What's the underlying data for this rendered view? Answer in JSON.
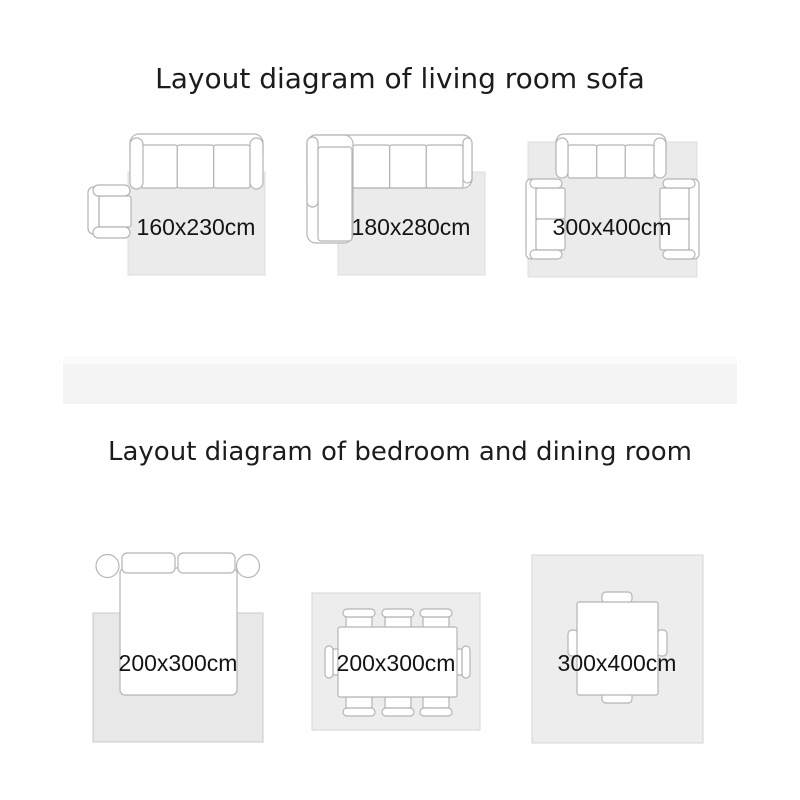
{
  "sections": {
    "living_room": {
      "title": "Layout diagram of living room sofa",
      "diagrams": [
        {
          "label": "160x230cm",
          "furniture": "three-seat sofa with side armchair on rug"
        },
        {
          "label": "180x280cm",
          "furniture": "L-shaped sectional sofa on rug"
        },
        {
          "label": "300x400cm",
          "furniture": "three-seat sofa with two facing armchairs on rug"
        }
      ]
    },
    "bedroom_dining": {
      "title": "Layout diagram of bedroom and dining room",
      "diagrams": [
        {
          "label": "200x300cm",
          "furniture": "double bed with pillows and two round nightstands on rug"
        },
        {
          "label": "200x300cm",
          "furniture": "dining table with eight chairs on rug"
        },
        {
          "label": "300x400cm",
          "furniture": "table with four chairs centered on large rug"
        }
      ]
    }
  },
  "colors": {
    "background": "#ffffff",
    "rug_living": "#ebebeb",
    "rug_bedroom": "#e8e8e8",
    "rug_dining": "#ededed",
    "furniture_outline": "#b5b5b5",
    "divider_band": "#f4f4f4",
    "title_text": "#1c1c1c",
    "label_text": "#141414"
  }
}
